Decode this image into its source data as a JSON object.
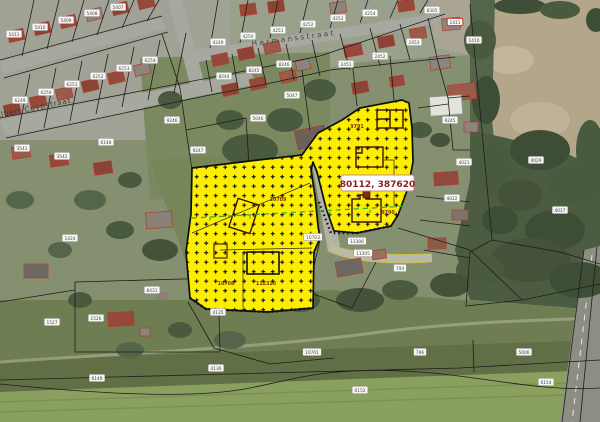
{
  "map": {
    "title": "cadastral-aerial-viewer",
    "callout_label": "80112, 387620",
    "streets": [
      {
        "name": "Albert Cuypstraat"
      },
      {
        "name": "Hermansstraat"
      }
    ],
    "selection": {
      "fill": "#fdee00",
      "border": "#0d0d0d",
      "hatch": "plus-grid",
      "labels": [
        {
          "x": 278,
          "y": 201,
          "t": "10709"
        },
        {
          "x": 226,
          "y": 285,
          "t": "10708"
        },
        {
          "x": 266,
          "y": 285,
          "t": "112320"
        },
        {
          "x": 357,
          "y": 128,
          "t": "9791"
        },
        {
          "x": 388,
          "y": 214,
          "t": "9790"
        }
      ]
    },
    "parcel_labels": [
      {
        "x": 14,
        "y": 34,
        "t": "5411"
      },
      {
        "x": 40,
        "y": 27,
        "t": "5410"
      },
      {
        "x": 66,
        "y": 20,
        "t": "5409"
      },
      {
        "x": 92,
        "y": 13,
        "t": "5408"
      },
      {
        "x": 118,
        "y": 7,
        "t": "5407"
      },
      {
        "x": 20,
        "y": 100,
        "t": "6249"
      },
      {
        "x": 46,
        "y": 92,
        "t": "6250"
      },
      {
        "x": 72,
        "y": 84,
        "t": "6251"
      },
      {
        "x": 98,
        "y": 76,
        "t": "6252"
      },
      {
        "x": 124,
        "y": 68,
        "t": "6253"
      },
      {
        "x": 150,
        "y": 60,
        "t": "6254"
      },
      {
        "x": 218,
        "y": 42,
        "t": "4249"
      },
      {
        "x": 248,
        "y": 36,
        "t": "4250"
      },
      {
        "x": 278,
        "y": 30,
        "t": "4251"
      },
      {
        "x": 308,
        "y": 24,
        "t": "4252"
      },
      {
        "x": 338,
        "y": 18,
        "t": "4253"
      },
      {
        "x": 370,
        "y": 13,
        "t": "4254"
      },
      {
        "x": 224,
        "y": 76,
        "t": "8244"
      },
      {
        "x": 254,
        "y": 70,
        "t": "8245"
      },
      {
        "x": 284,
        "y": 64,
        "t": "8246"
      },
      {
        "x": 22,
        "y": 148,
        "t": "3541"
      },
      {
        "x": 62,
        "y": 156,
        "t": "3542"
      },
      {
        "x": 106,
        "y": 142,
        "t": "6148"
      },
      {
        "x": 172,
        "y": 120,
        "t": "9246"
      },
      {
        "x": 198,
        "y": 150,
        "t": "9247"
      },
      {
        "x": 258,
        "y": 118,
        "t": "5046"
      },
      {
        "x": 292,
        "y": 95,
        "t": "5047"
      },
      {
        "x": 346,
        "y": 64,
        "t": "2451"
      },
      {
        "x": 380,
        "y": 56,
        "t": "2452"
      },
      {
        "x": 414,
        "y": 42,
        "t": "2453"
      },
      {
        "x": 432,
        "y": 10,
        "t": "8305"
      },
      {
        "x": 455,
        "y": 22,
        "t": "1411",
        "red": true
      },
      {
        "x": 474,
        "y": 40,
        "t": "1410"
      },
      {
        "x": 450,
        "y": 120,
        "t": "9245"
      },
      {
        "x": 464,
        "y": 162,
        "t": "4021"
      },
      {
        "x": 452,
        "y": 198,
        "t": "4022"
      },
      {
        "x": 536,
        "y": 160,
        "t": "4029"
      },
      {
        "x": 560,
        "y": 210,
        "t": "4017"
      },
      {
        "x": 524,
        "y": 352,
        "t": "5006"
      },
      {
        "x": 70,
        "y": 238,
        "t": "1424"
      },
      {
        "x": 52,
        "y": 322,
        "t": "1527"
      },
      {
        "x": 96,
        "y": 318,
        "t": "1526"
      },
      {
        "x": 152,
        "y": 290,
        "t": "8431"
      },
      {
        "x": 218,
        "y": 312,
        "t": "4135"
      },
      {
        "x": 313,
        "y": 237,
        "t": "10703"
      },
      {
        "x": 357,
        "y": 241,
        "t": "11306"
      },
      {
        "x": 363,
        "y": 253,
        "t": "11305"
      },
      {
        "x": 312,
        "y": 352,
        "t": "10701"
      },
      {
        "x": 400,
        "y": 268,
        "t": "794"
      },
      {
        "x": 420,
        "y": 352,
        "t": "796"
      },
      {
        "x": 97,
        "y": 378,
        "t": "6149"
      },
      {
        "x": 216,
        "y": 368,
        "t": "4136"
      },
      {
        "x": 546,
        "y": 382,
        "t": "6154"
      },
      {
        "x": 360,
        "y": 390,
        "t": "6152"
      }
    ],
    "colors": {
      "callout_text": "#8b1f1f",
      "parcel_line": "#1f1d1a",
      "building_outline": "#c23b2e",
      "survey_line": "#2fae2f"
    }
  }
}
